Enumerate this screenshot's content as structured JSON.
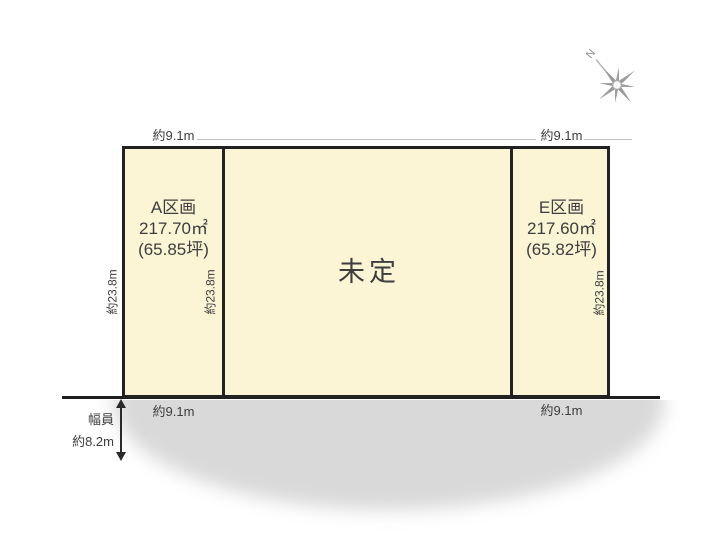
{
  "compass": {
    "north_label": "N"
  },
  "parcels": {
    "a": {
      "name": "A区画",
      "area": "217.70㎡",
      "tsubo": "(65.85坪)"
    },
    "center": {
      "label": "未定"
    },
    "e": {
      "name": "E区画",
      "area": "217.60㎡",
      "tsubo": "(65.82坪)"
    }
  },
  "dimensions": {
    "top_left": "約9.1m",
    "top_right": "約9.1m",
    "bottom_left": "約9.1m",
    "bottom_right": "約9.1m",
    "depth_left": "約23.8m",
    "depth_middle": "約23.8m",
    "depth_right": "約23.8m",
    "road_label": "幅員",
    "road_width": "約8.2m"
  },
  "colors": {
    "parcel_fill": "#fbf4d5",
    "border": "#222222",
    "road": "#d9d9d9",
    "text": "#3d3d3d",
    "compass": "#9b9b9b"
  }
}
